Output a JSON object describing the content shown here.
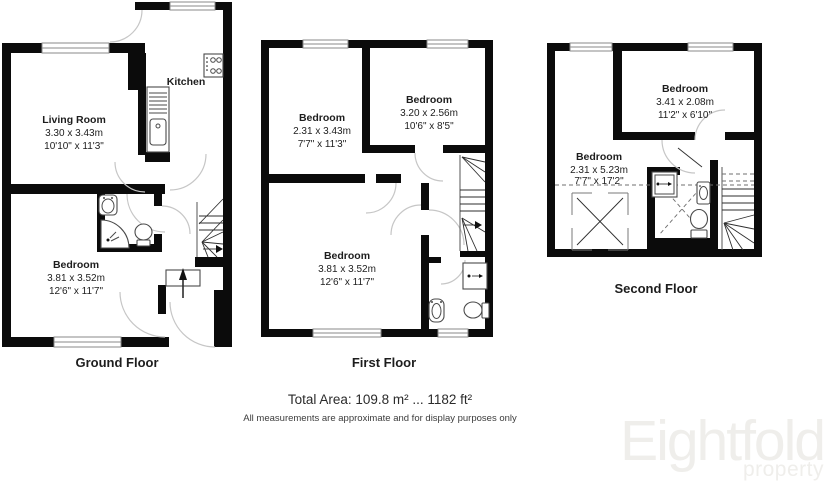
{
  "footer": {
    "total_area": "Total Area: 109.8 m² ... 1182 ft²",
    "disclaimer": "All measurements are approximate and for display purposes only"
  },
  "logo": {
    "brand": "Eightfold",
    "subtitle": "property"
  },
  "colors": {
    "wall": "#0B0B0B",
    "text": "#1D1D1D",
    "logo_watermark": "#EFEEEB"
  },
  "floors": {
    "ground": {
      "label": "Ground Floor",
      "rooms": {
        "living": {
          "name": "Living Room",
          "metric": "3.30 x 3.43m",
          "imperial": "10'10\" x 11'3\""
        },
        "kitchen": {
          "name": "Kitchen"
        },
        "bedroom": {
          "name": "Bedroom",
          "metric": "3.81 x 3.52m",
          "imperial": "12'6\" x 11'7\""
        }
      }
    },
    "first": {
      "label": "First Floor",
      "rooms": {
        "bedroom1": {
          "name": "Bedroom",
          "metric": "2.31 x 3.43m",
          "imperial": "7'7\" x 11'3\""
        },
        "bedroom2": {
          "name": "Bedroom",
          "metric": "3.20 x 2.56m",
          "imperial": "10'6\" x 8'5\""
        },
        "bedroom3": {
          "name": "Bedroom",
          "metric": "3.81 x 3.52m",
          "imperial": "12'6\" x 11'7\""
        }
      }
    },
    "second": {
      "label": "Second Floor",
      "rooms": {
        "bedroom1": {
          "name": "Bedroom",
          "metric": "3.41 x 2.08m",
          "imperial": "11'2\" x 6'10\""
        },
        "bedroom2": {
          "name": "Bedroom",
          "metric": "2.31 x 5.23m",
          "imperial": "7'7\" x 17'2\""
        }
      }
    }
  }
}
